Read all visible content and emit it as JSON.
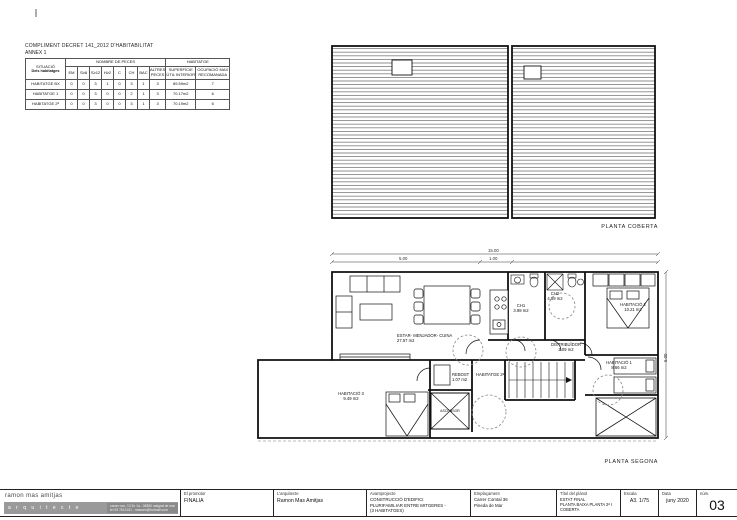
{
  "compliance_table": {
    "title": "COMPLIMENT DECRET 141_2012 D'HABITABILITAT",
    "subtitle": "ANNEX 1",
    "situacio_header": "SITUACIÓ",
    "situacio_sub": "Dels habitatges",
    "group_peces": "NOMBRE DE PECES",
    "group_habitatge": "HABITATGE",
    "piece_cols": [
      "EM",
      "S≥8",
      "S≥12",
      "H≥2",
      "C",
      "CH",
      "BAC",
      "ALTRES PECES"
    ],
    "surface_col": "SUPERFÍCIE ÚTIL INTERIOR",
    "occupancy_col": "OCUPACIÓ MAX RECOMANADA",
    "rows": [
      {
        "label": "HABITATGE BX",
        "v": [
          "0",
          "0",
          "3",
          "1",
          "0",
          "3",
          "1",
          "3"
        ],
        "surface": "89.59m2",
        "occupancy": "7"
      },
      {
        "label": "HABITATGE 1",
        "v": [
          "0",
          "0",
          "3",
          "0",
          "0",
          "2",
          "1",
          "3"
        ],
        "surface": "70.17m2",
        "occupancy": "6"
      },
      {
        "label": "HABITATGE 2ª",
        "v": [
          "0",
          "0",
          "3",
          "0",
          "0",
          "3",
          "1",
          "3"
        ],
        "surface": "70.19m2",
        "occupancy": "6"
      }
    ]
  },
  "roof_plan": {
    "label": "PLANTA COBERTA"
  },
  "floor_plan": {
    "label": "PLANTA SEGONA",
    "unit_tag": "HABITATGE 2ª",
    "elevator_label": "ASCENSOR",
    "rooms": [
      {
        "name": "ESTAR- MENJADOR- CUINA",
        "area": "27.57 m2"
      },
      {
        "name": "CH1",
        "area": "3.98 m2"
      },
      {
        "name": "CH2",
        "area": "4.59 m2"
      },
      {
        "name": "DISTRIBUÏDOR",
        "area": "2.09 m2"
      },
      {
        "name": "HABITACIÓ 2",
        "area": "10.21 m2"
      },
      {
        "name": "HABITACIÓ 1",
        "area": "8.66 m2"
      },
      {
        "name": "HABITACIÓ 3",
        "area": "9.49 m2"
      },
      {
        "name": "REBOST",
        "area": "1.07 m2"
      }
    ],
    "dimensions": {
      "total": "15.00",
      "seg_a": "5.00",
      "seg_b": "1.00",
      "right": "5.00"
    }
  },
  "title_block": {
    "studio_name": "ramon mas amitjas",
    "studio_tagline": "a r q u i t e c t e",
    "studio_address": "carrer nou, 13 2n 1a - 08380 malgrat de mar",
    "studio_contact": "tel 93 7612151 - masram@hotmail.com",
    "promoter_label": "El promotor",
    "promoter_value": "FINALIA",
    "architect_label": "L'arquitecte",
    "architect_value": "Ramon Mas Amitjas",
    "project_label": "Avantprojecte",
    "project_value_1": "CONSTRUCCIÓ D'EDIFICI",
    "project_value_2": "PLURIFAMILIAR ENTRE MITGERES -",
    "project_value_3": "(3 HABITATGES)",
    "location_label": "Emplaçament",
    "location_value_1": "Carrer Comtal 36",
    "location_value_2": "Pineda de Mar",
    "sheet_title_label": "Títol del plànol",
    "sheet_title_value_1": "ESTAT FINAL",
    "sheet_title_value_2": "PLANTA BAIXA PLANTA 2ª I COBERTA",
    "scale_label": "Escala",
    "scale_value": "A3. 1/75",
    "date_label": "Data",
    "date_value": "juny 2020",
    "number_label": "núm.",
    "number_value": "03"
  }
}
